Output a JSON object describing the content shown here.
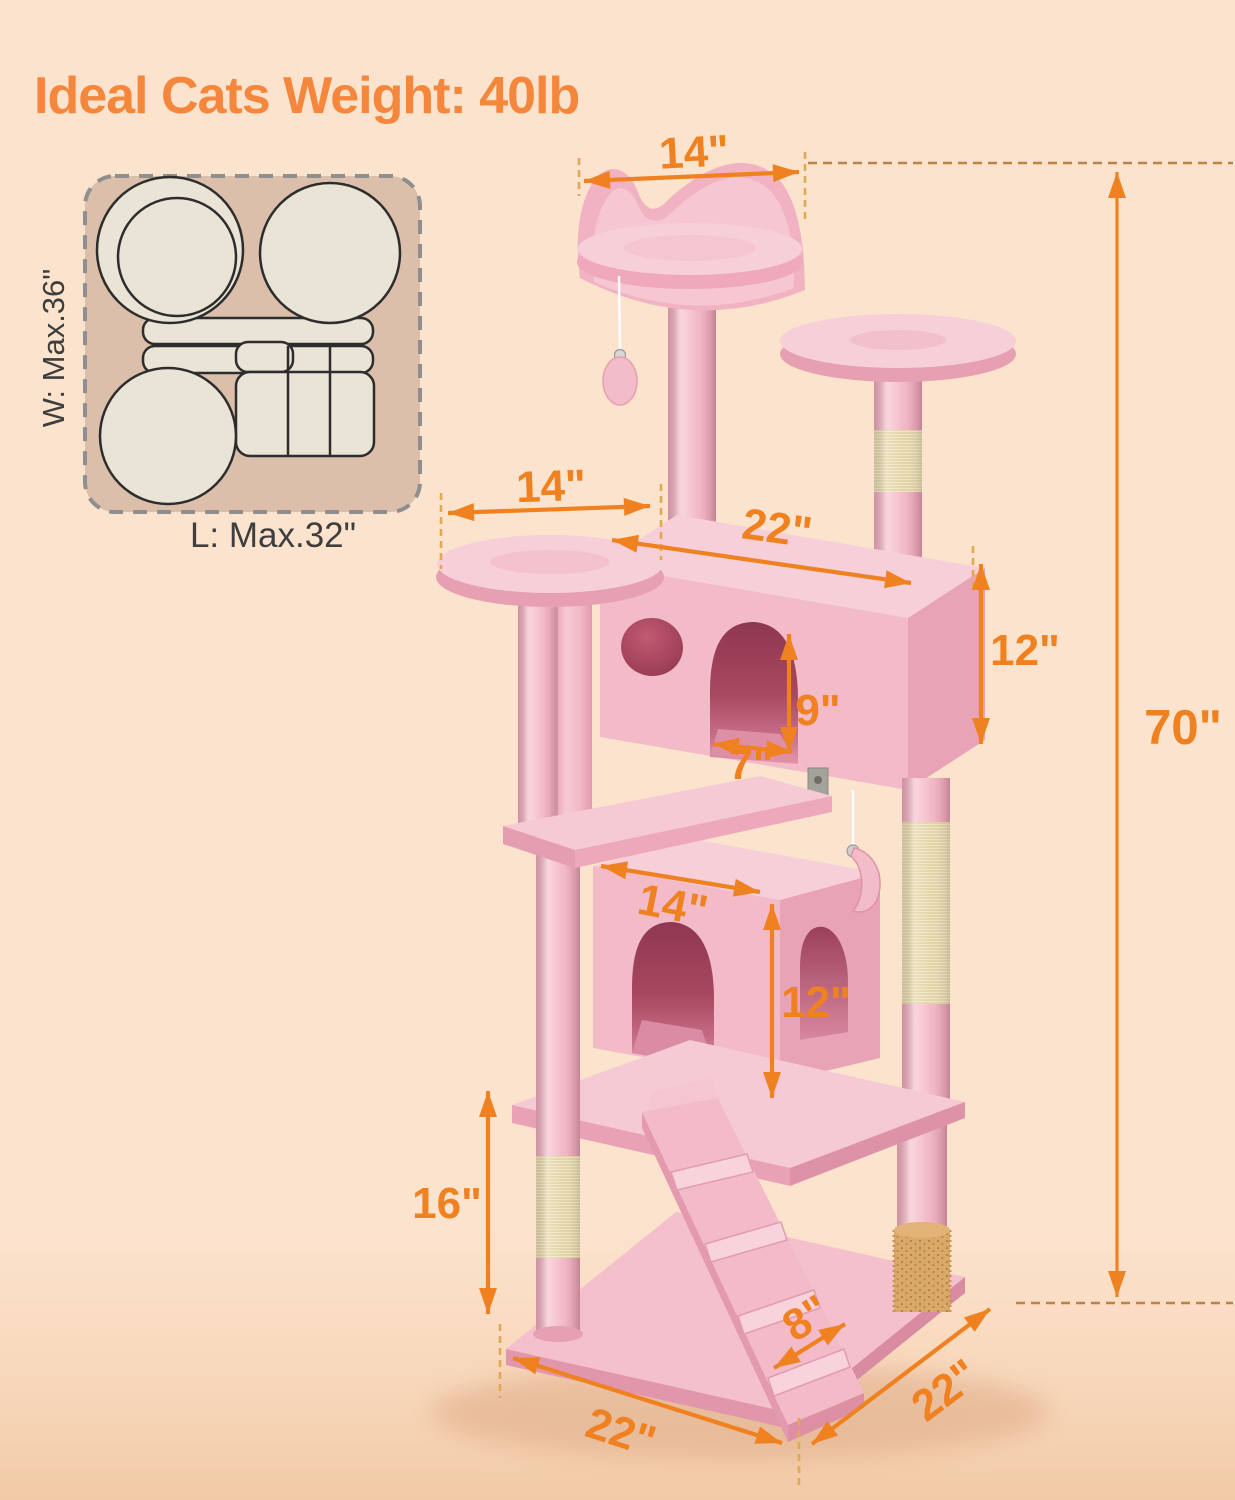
{
  "title": "Ideal Cats Weight: 40lb",
  "footprint": {
    "width_label": "W: Max.36\"",
    "length_label": "L: Max.32\""
  },
  "dimensions": {
    "top_perch_width": "14\"",
    "left_platform_width": "14\"",
    "upper_condo_width": "22\"",
    "upper_condo_height": "12\"",
    "entrance_height": "9\"",
    "entrance_width": "7\"",
    "lower_condo_width": "14\"",
    "lower_condo_height": "12\"",
    "clearance_height": "16\"",
    "ramp_width": "8\"",
    "base_depth": "22\"",
    "base_width": "22\"",
    "total_height": "70\""
  },
  "colors": {
    "background": "#FCE3CD",
    "annotation_orange": "#F08120",
    "title_orange": "#F5873D",
    "tree_pink": "#F3BAC8",
    "sisal": "#F1E6C4",
    "footprint_tan": "#DCBFAB"
  }
}
